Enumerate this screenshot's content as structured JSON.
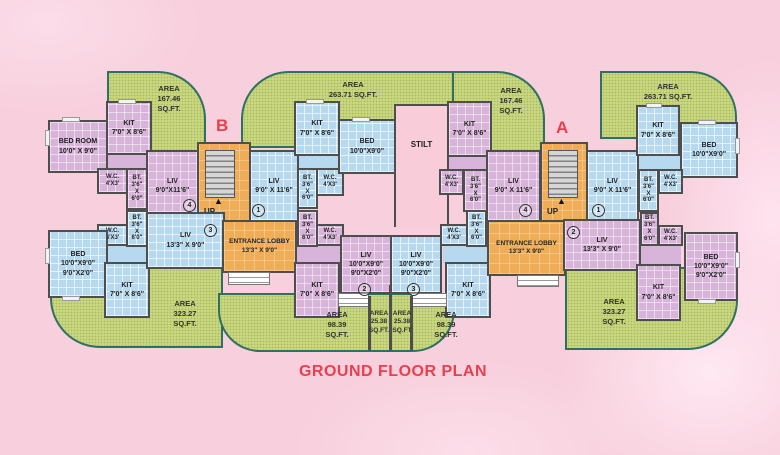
{
  "title": "GROUND FLOOR PLAN",
  "labels": {
    "wing_b": "B",
    "wing_a": "A",
    "stilt": "STILT",
    "up": "UP"
  },
  "numbers": {
    "n1": "1",
    "n2": "2",
    "n3": "3",
    "n4": "4"
  },
  "green_areas": {
    "b_tl": "AREA\n167.46\nSQ.FT.",
    "b_top": "AREA\n263.71 SQ.FT.",
    "b_bl": "AREA\n323.27\nSQ.FT.",
    "a_tl": "AREA\n167.46\nSQ.FT.",
    "a_top": "AREA\n263.71 SQ.FT.",
    "a_br": "AREA\n323.27\nSQ.FT.",
    "bottom_left": "AREA\n98.39\nSQ.FT.",
    "bottom_mid_left": "AREA\n25.38\nSQ.FT.",
    "bottom_mid_right": "AREA\n25.38\nSQ.FT",
    "bottom_right": "AREA\n98.39\nSQ.FT."
  },
  "rooms": {
    "b4_bedroom": "BED ROOM\n10'0\" X 9'0\"",
    "b4_kit": "KIT\n7'0\" X 8'6\"",
    "b4_wc": "W.C.\n4'X3'",
    "b4_bt": "BT.\n3'6\"\nX\n6'0\"",
    "b4_liv": "LIV\n9'0\"X11'6\"",
    "b1_liv": "LIV\n9'0\" X 11'6\"",
    "b1_kit": "KIT\n7'0\" X 8'6\"",
    "b1_bed": "BED\n10'0\"X9'0\"",
    "b1_bt": "BT.\n3'6\"\nX\n6'0\"",
    "b1_wc": "W.C.\n4'X3'",
    "b3_bed": "BED\n10'0\"X9'0\"\n9'0\"X2'0\"",
    "b3_kit": "KIT\n7'0\" X 8'6\"",
    "b3_liv": "LIV\n13'3\" X 9'0\"",
    "b3_wc": "W.C.\n4'X3'",
    "b3_bt": "BT.\n3'6\"\nX\n6'0\"",
    "b2_liv": "LIV\n10'0\"X9'0\"\n9'0\"X2'0\"",
    "b2_kit": "KIT\n7'0\" X 8'6\"",
    "b2_wc": "W.C.\n4'X3'",
    "b2_bt": "BT.\n3'6\"\nX\n6'0\"",
    "b_lobby": "ENTRANCE LOBBY\n13'3\" X 9'0\"",
    "a4_kit": "KIT\n7'0\" X 8'6\"",
    "a4_wc": "W.C.\n4'X3'",
    "a4_bt": "BT.\n3'6\"\nX\n6'0\"",
    "a4_liv": "LIV\n9'0\" X 11'6\"",
    "a1_liv": "LIV\n9'0\" X 11'6\"",
    "a1_kit": "KIT\n7'0\" X 8'6\"",
    "a1_bed": "BED\n10'0\"X9'0\"",
    "a1_bt": "BT.\n3'6\"\nX\n6'0\"",
    "a1_wc": "W.C.\n4'X3'",
    "a3_liv": "LIV\n10'0\"X9'0\"\n9'0\"X2'0\"",
    "a3_wc": "W.C.\n4'X3'",
    "a3_bt": "BT.\n3'6\"\nX\n6'0\"",
    "a3_kit": "KIT\n7'0\" X 8'6\"",
    "a2_liv": "LIV\n13'3\" X 9'0\"",
    "a2_bt": "BT.\n3'6\"\nX\n6'0\"",
    "a2_wc": "W.C.\n4'X3'",
    "a2_bed": "BED\n10'0\"X9'0\"\n9'0\"X2'0\"",
    "a2_kit": "KIT\n7'0\" X 8'6\"",
    "a_lobby": "ENTRANCE LOBBY\n13'3\" X 9'0\""
  }
}
